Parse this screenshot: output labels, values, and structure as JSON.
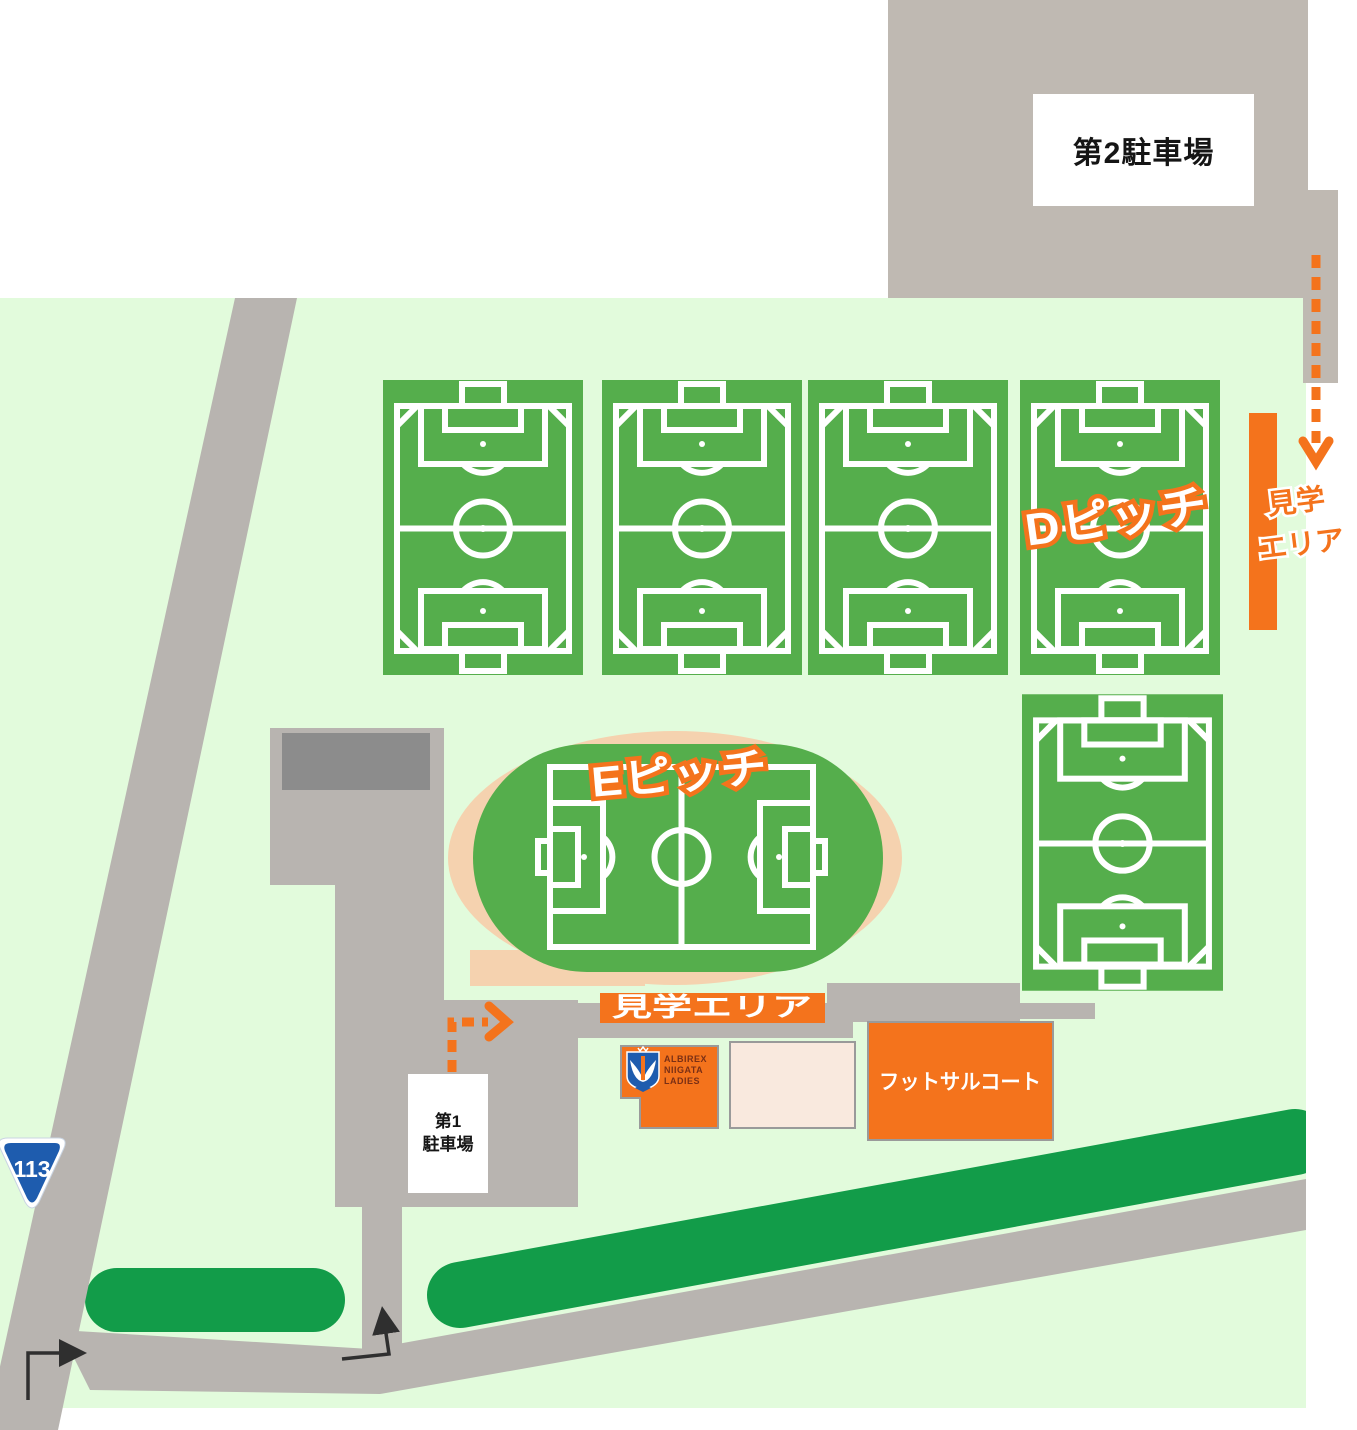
{
  "map": {
    "title_hint": "training-ground-guide-map",
    "colors": {
      "background": "#FFFFFF",
      "grounds_green": "#E2FBDC",
      "pitch_green": "#55AE4C",
      "pitch_line_white": "#FFFFFF",
      "hedge_green": "#129C49",
      "parking_gray": "#BFB9B2",
      "road_gray": "#B8B4B0",
      "building_dark_gray": "#8C8C8C",
      "accent_orange": "#F4731C",
      "track_peach": "#F5D2AF",
      "annex_beige": "#F9E9DE",
      "route_badge_blue": "#1E5CAE",
      "arrow_black": "#2F2F2F"
    }
  },
  "labels": {
    "parking2": "第2駐車場",
    "parking1_line1": "第1",
    "parking1_line2": "駐車場",
    "pitch_d": "Dピッチ",
    "pitch_e": "Eピッチ",
    "viewing_area_right_line1": "見学",
    "viewing_area_right_line2": "エリア",
    "viewing_area_bottom": "見学エリア",
    "futsal_court": "フットサルコート",
    "route_number": "113"
  },
  "clubhouse_logo": {
    "line1": "ALBIREX",
    "line2": "NIIGATA",
    "line3": "LADIES"
  }
}
